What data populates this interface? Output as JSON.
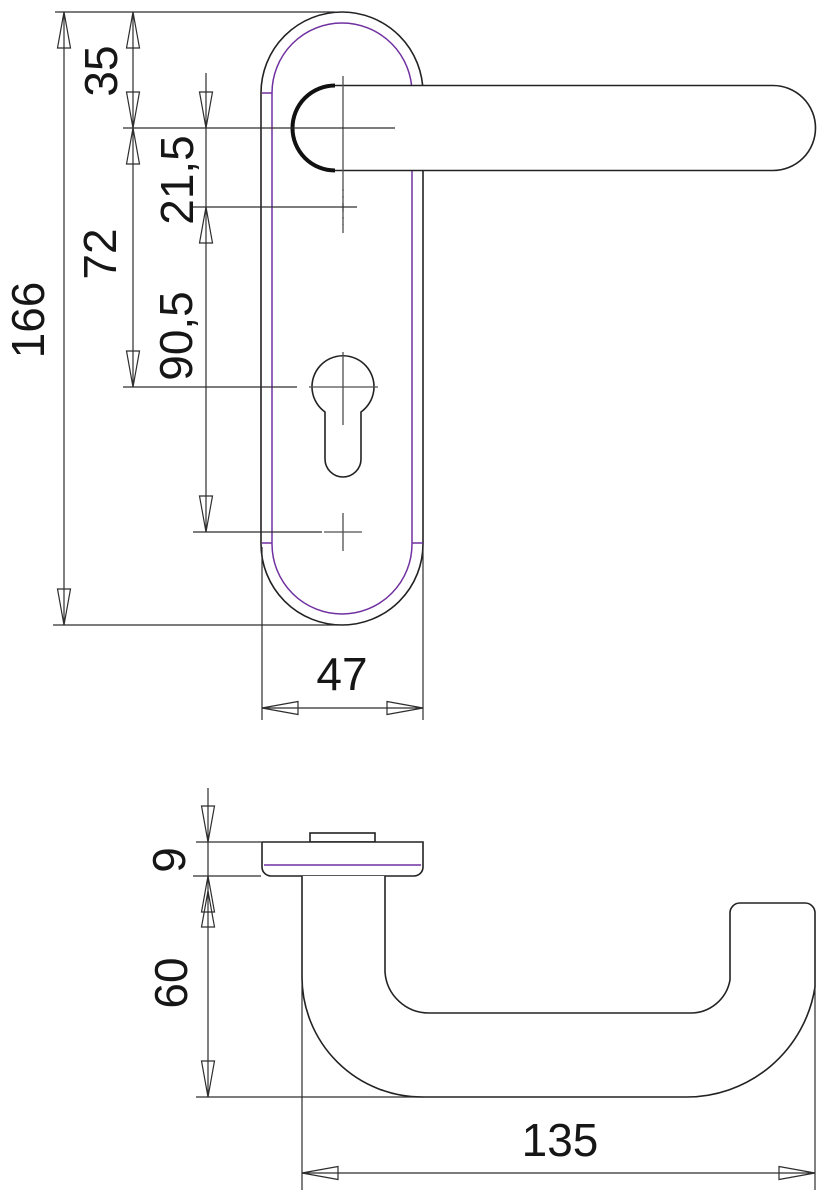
{
  "drawing": {
    "colors": {
      "line": "#222222",
      "accent_inner_plate": "#7030a0",
      "centerline": "#4f4f4f",
      "background": "#ffffff"
    },
    "front_view": {
      "dims": {
        "overall_height": "166",
        "top_to_handle": "35",
        "handle_to_upper": "21,5",
        "handle_to_cylinder": "72",
        "hole_spacing": "90,5",
        "plate_width": "47"
      }
    },
    "side_view": {
      "dims": {
        "plate_thickness": "9",
        "projection": "60",
        "length": "135"
      }
    }
  }
}
